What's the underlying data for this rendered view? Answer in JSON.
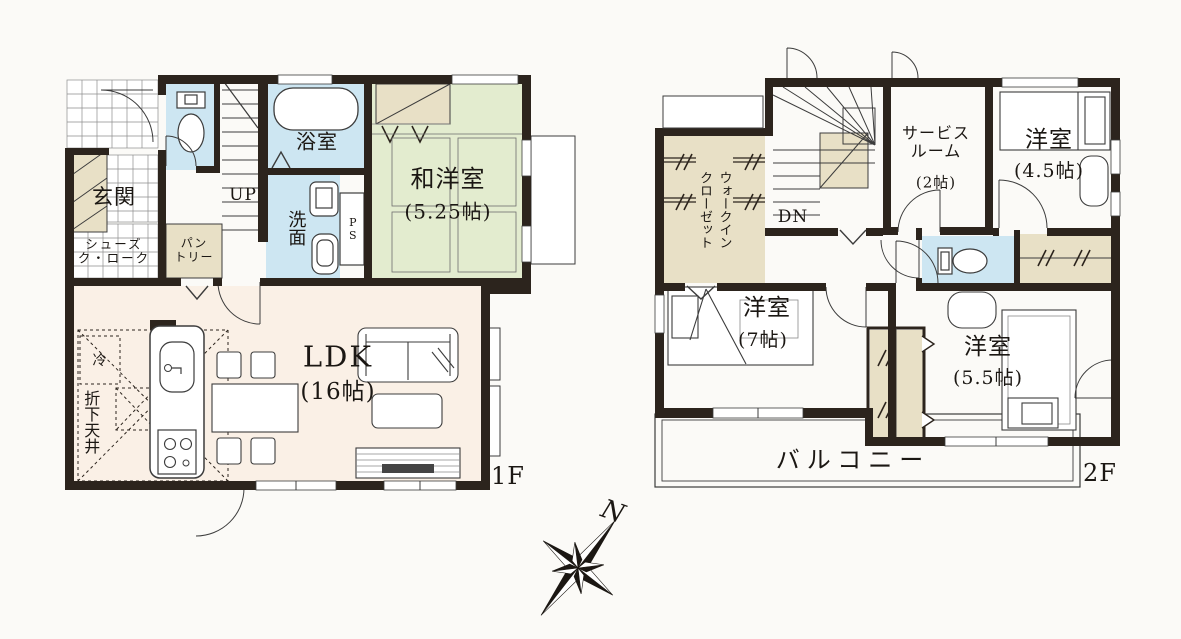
{
  "document": {
    "type": "residential floor plan",
    "floors_shown": 2
  },
  "colors": {
    "wall": "#2c241d",
    "water_room_blue": "#cde6f2",
    "tatami_green": "#e3eccf",
    "closet_beige": "#e8e0c6",
    "ldk_cream": "#faf0e6",
    "background": "#fbfaf7",
    "line": "#3c3c3c"
  },
  "floor1": {
    "floor_label": "1F",
    "genkan": "玄関",
    "shoes_closet": "シューズ\nク・ローク",
    "pantry": "パン\nトリー",
    "stairs_up": "UP",
    "bathroom": "浴室",
    "washroom": "洗面",
    "pipe_space": "PS",
    "japanese_western_room": "和洋室",
    "japanese_western_room_size": "(5.25帖)",
    "ldk": "LDK",
    "ldk_size": "(16帖)",
    "refrigerator": "冷",
    "lowered_ceiling": "折下天井"
  },
  "floor2": {
    "floor_label": "2F",
    "walk_in_closet": "ウォークイン\nクローゼット",
    "stairs_down": "DN",
    "service_room": "サービス\nルーム",
    "service_room_size": "(2帖)",
    "western_room_a": "洋室",
    "western_room_a_size": "(4.5帖)",
    "western_room_b": "洋室",
    "western_room_b_size": "(7帖)",
    "western_room_c": "洋室",
    "western_room_c_size": "(5.5帖)",
    "balcony": "バルコニー"
  },
  "compass": {
    "north": "N"
  }
}
